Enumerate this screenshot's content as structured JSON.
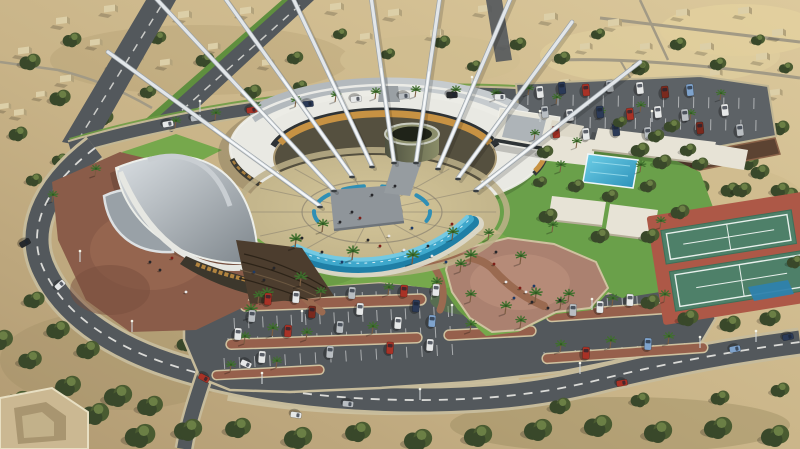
{
  "scene": {
    "title": "aerial-architectural-rendering",
    "description": "Aerial 3D render of a circular cultural center with white sail masts, crescent cascade pool, central plaza, lawns, palm-lined parking lots, pavilions with swimming pool, tennis courts and a ring road in a desert town",
    "features": {
      "masts": 9,
      "tennis_courts": 2,
      "swimming_pools": 1,
      "parking_lots": 2,
      "central_plaza": 1,
      "cascade_pool": 1
    }
  },
  "palette": {
    "sand_light": "#dcc99c",
    "sand_dark": "#b7a077",
    "sand_patch": "#a8946a",
    "sand_bright": "#e3d2a0",
    "scrub": "#4a5b31",
    "scrub_dark": "#39482a",
    "scrub_lite": "#6b7f45",
    "asphalt": "#53585c",
    "asphalt_lite": "#5d6266",
    "road_line": "#e9e9e4",
    "curb": "#c6bb9b",
    "grass": "#76a84c",
    "grass_dark": "#5f8f3e",
    "grass_east": "#6aa04a",
    "gravel": "#8a5c49",
    "gravel_lite": "#9c6b54",
    "pink_gravel": "#ab8170",
    "path_brown": "#9a6a50",
    "plaza_tile": "#cbbd92",
    "plaza_tile_dark": "#b6a981",
    "plaza_joint": "#8a8270",
    "water": "#3fa8cc",
    "water_deep": "#1f7fa6",
    "water_lite": "#74c9e2",
    "roof_white": "#e9e9e3",
    "roof_gray": "#b3b9bd",
    "glass_dark": "#2e3336",
    "gold": "#c79243",
    "drum_lite": "#8a8d68",
    "drum_dark": "#4e5140",
    "pavilion": "#e7e3d6",
    "court_red": "#ad5847",
    "court_green": "#4e8069",
    "mast": "#e2e6e9"
  },
  "car_colors": {
    "white": "#e6e8e8",
    "silver": "#b9bec2",
    "red": "#a83226",
    "darkred": "#7a2a1e",
    "navy": "#2b3a57",
    "black": "#26282b",
    "blue": "#7fa3cc"
  },
  "desert_buildings": [
    [
      18,
      48,
      1
    ],
    [
      56,
      18,
      1
    ],
    [
      104,
      6,
      1
    ],
    [
      178,
      12,
      1
    ],
    [
      240,
      8,
      1
    ],
    [
      330,
      4,
      1
    ],
    [
      388,
      10,
      1
    ],
    [
      430,
      30,
      1
    ],
    [
      478,
      6,
      1
    ],
    [
      544,
      14,
      1
    ],
    [
      608,
      20,
      1
    ],
    [
      676,
      10,
      1
    ],
    [
      738,
      8,
      1
    ],
    [
      772,
      30,
      1
    ],
    [
      700,
      44,
      1
    ],
    [
      756,
      54,
      1
    ],
    [
      60,
      76,
      1
    ],
    [
      14,
      110,
      0.9
    ],
    [
      130,
      54,
      1
    ],
    [
      208,
      44,
      0.9
    ],
    [
      262,
      60,
      0.9
    ],
    [
      360,
      34,
      0.9
    ],
    [
      580,
      44,
      0.9
    ],
    [
      640,
      44,
      0.9
    ],
    [
      710,
      70,
      0.9
    ],
    [
      770,
      90,
      0.9
    ],
    [
      0,
      104,
      0.8
    ],
    [
      36,
      92,
      0.8
    ],
    [
      90,
      40,
      0.9
    ],
    [
      160,
      60,
      0.9
    ],
    [
      500,
      40,
      0.9
    ],
    [
      560,
      80,
      0.8
    ]
  ],
  "trees_far": [
    [
      30,
      62,
      9
    ],
    [
      72,
      40,
      8
    ],
    [
      118,
      66,
      9
    ],
    [
      158,
      38,
      7
    ],
    [
      205,
      60,
      8
    ],
    [
      248,
      40,
      7
    ],
    [
      295,
      58,
      7
    ],
    [
      340,
      34,
      6
    ],
    [
      388,
      54,
      6
    ],
    [
      442,
      42,
      7
    ],
    [
      474,
      66,
      6
    ],
    [
      518,
      44,
      7
    ],
    [
      562,
      58,
      7
    ],
    [
      598,
      34,
      6
    ],
    [
      252,
      92,
      8
    ],
    [
      300,
      86,
      6
    ],
    [
      60,
      98,
      9
    ],
    [
      18,
      134,
      8
    ],
    [
      104,
      118,
      8
    ],
    [
      148,
      92,
      7
    ],
    [
      196,
      88,
      6
    ],
    [
      640,
      68,
      8
    ],
    [
      678,
      44,
      7
    ],
    [
      718,
      64,
      7
    ],
    [
      758,
      40,
      6
    ],
    [
      786,
      68,
      6
    ],
    [
      700,
      94,
      7
    ],
    [
      744,
      108,
      7
    ],
    [
      780,
      128,
      8
    ],
    [
      638,
      118,
      7
    ],
    [
      608,
      92,
      6
    ],
    [
      662,
      132,
      7
    ],
    [
      700,
      160,
      8
    ],
    [
      748,
      162,
      9
    ],
    [
      788,
      196,
      9
    ],
    [
      760,
      172,
      8
    ],
    [
      730,
      190,
      8
    ],
    [
      795,
      232,
      8
    ],
    [
      60,
      160,
      7
    ],
    [
      34,
      180,
      7
    ],
    [
      120,
      214,
      8
    ],
    [
      100,
      250,
      7
    ],
    [
      148,
      320,
      8
    ],
    [
      186,
      344,
      8
    ],
    [
      656,
      196,
      8
    ],
    [
      700,
      188,
      8
    ],
    [
      742,
      190,
      8
    ],
    [
      780,
      190,
      8
    ]
  ],
  "trees_mid": [
    [
      545,
      152,
      7
    ],
    [
      640,
      150,
      8
    ],
    [
      656,
      136,
      7
    ],
    [
      576,
      186,
      7
    ],
    [
      648,
      186,
      7
    ],
    [
      610,
      196,
      7
    ],
    [
      548,
      216,
      8
    ],
    [
      600,
      236,
      8
    ],
    [
      650,
      236,
      8
    ],
    [
      680,
      212,
      8
    ],
    [
      620,
      122,
      6
    ],
    [
      672,
      126,
      7
    ],
    [
      700,
      164,
      7
    ],
    [
      540,
      182,
      6
    ],
    [
      662,
      162,
      8
    ],
    [
      688,
      150,
      7
    ]
  ],
  "trees_near": [
    [
      48,
      430,
      14
    ],
    [
      95,
      414,
      12
    ],
    [
      140,
      436,
      13
    ],
    [
      188,
      430,
      12
    ],
    [
      238,
      428,
      11
    ],
    [
      298,
      438,
      12
    ],
    [
      358,
      432,
      11
    ],
    [
      418,
      440,
      12
    ],
    [
      478,
      436,
      12
    ],
    [
      538,
      430,
      12
    ],
    [
      598,
      426,
      12
    ],
    [
      658,
      432,
      12
    ],
    [
      718,
      428,
      12
    ],
    [
      775,
      436,
      12
    ],
    [
      18,
      402,
      12
    ],
    [
      68,
      386,
      11
    ],
    [
      118,
      396,
      12
    ],
    [
      30,
      360,
      10
    ],
    [
      58,
      330,
      10
    ],
    [
      34,
      300,
      9
    ],
    [
      88,
      350,
      10
    ],
    [
      150,
      406,
      11
    ],
    [
      0,
      340,
      11
    ],
    [
      650,
      302,
      8
    ],
    [
      688,
      318,
      9
    ],
    [
      730,
      324,
      9
    ],
    [
      770,
      318,
      9
    ],
    [
      795,
      262,
      7
    ],
    [
      560,
      406,
      9
    ],
    [
      640,
      400,
      8
    ],
    [
      720,
      398,
      8
    ],
    [
      780,
      390,
      8
    ]
  ],
  "palms": [
    [
      175,
      128,
      0.8
    ],
    [
      215,
      120,
      0.8
    ],
    [
      255,
      113,
      0.8
    ],
    [
      295,
      107,
      0.8
    ],
    [
      335,
      102,
      0.8
    ],
    [
      375,
      99,
      0.8
    ],
    [
      415,
      97,
      0.8
    ],
    [
      455,
      97,
      0.8
    ],
    [
      495,
      100,
      0.8
    ],
    [
      295,
      248,
      1
    ],
    [
      322,
      232,
      0.9
    ],
    [
      352,
      260,
      1
    ],
    [
      300,
      286,
      1
    ],
    [
      266,
      302,
      1
    ],
    [
      412,
      264,
      1
    ],
    [
      452,
      240,
      0.9
    ],
    [
      470,
      264,
      1
    ],
    [
      488,
      240,
      0.8
    ],
    [
      520,
      264,
      0.9
    ],
    [
      535,
      302,
      1
    ],
    [
      505,
      314,
      0.9
    ],
    [
      568,
      302,
      0.9
    ],
    [
      250,
      318,
      1
    ],
    [
      272,
      336,
      0.9
    ],
    [
      436,
      290,
      0.9
    ],
    [
      460,
      272,
      0.9
    ],
    [
      52,
      202,
      0.8
    ],
    [
      95,
      176,
      0.8
    ],
    [
      258,
      303,
      0.85
    ],
    [
      320,
      299,
      0.85
    ],
    [
      388,
      295,
      0.85
    ],
    [
      470,
      302,
      0.85
    ],
    [
      560,
      309,
      0.85
    ],
    [
      612,
      306,
      0.85
    ],
    [
      664,
      302,
      0.85
    ],
    [
      244,
      344,
      0.85
    ],
    [
      306,
      340,
      0.85
    ],
    [
      372,
      334,
      0.85
    ],
    [
      470,
      332,
      0.85
    ],
    [
      520,
      328,
      0.85
    ],
    [
      560,
      352,
      0.85
    ],
    [
      610,
      348,
      0.85
    ],
    [
      668,
      344,
      0.85
    ],
    [
      230,
      372,
      0.8
    ],
    [
      276,
      368,
      0.8
    ],
    [
      528,
      95,
      0.75
    ],
    [
      556,
      104,
      0.75
    ],
    [
      600,
      118,
      0.75
    ],
    [
      640,
      112,
      0.75
    ],
    [
      690,
      120,
      0.75
    ],
    [
      720,
      100,
      0.75
    ],
    [
      534,
      140,
      0.75
    ],
    [
      576,
      148,
      0.75
    ],
    [
      560,
      172,
      0.8
    ],
    [
      640,
      172,
      0.8
    ],
    [
      552,
      232,
      0.8
    ],
    [
      660,
      228,
      0.8
    ]
  ],
  "stall_rows": [
    [
      238,
      298,
      445,
      288,
      15
    ],
    [
      234,
      318,
      448,
      306,
      15
    ],
    [
      228,
      338,
      450,
      326,
      15
    ],
    [
      224,
      358,
      452,
      344,
      15
    ],
    [
      548,
      302,
      696,
      292,
      10
    ],
    [
      544,
      352,
      700,
      342,
      10
    ],
    [
      528,
      94,
      754,
      98,
      15
    ],
    [
      530,
      116,
      756,
      120,
      15
    ]
  ],
  "parked_cars": [
    [
      268,
      299,
      4,
      "red"
    ],
    [
      296,
      297,
      4,
      "white"
    ],
    [
      352,
      293,
      4,
      "silver"
    ],
    [
      404,
      291,
      4,
      "red"
    ],
    [
      436,
      290,
      4,
      "white"
    ],
    [
      252,
      316,
      4,
      "silver"
    ],
    [
      312,
      312,
      4,
      "darkred"
    ],
    [
      360,
      309,
      4,
      "white"
    ],
    [
      416,
      306,
      4,
      "navy"
    ],
    [
      238,
      334,
      4,
      "white"
    ],
    [
      288,
      331,
      4,
      "red"
    ],
    [
      340,
      327,
      4,
      "silver"
    ],
    [
      398,
      323,
      4,
      "white"
    ],
    [
      432,
      321,
      4,
      "blue"
    ],
    [
      262,
      357,
      4,
      "white"
    ],
    [
      330,
      352,
      4,
      "silver"
    ],
    [
      390,
      348,
      4,
      "red"
    ],
    [
      430,
      345,
      4,
      "white"
    ],
    [
      573,
      310,
      2,
      "silver"
    ],
    [
      600,
      307,
      2,
      "white"
    ],
    [
      586,
      353,
      2,
      "red"
    ],
    [
      648,
      344,
      2,
      "blue"
    ],
    [
      630,
      300,
      2,
      "white"
    ],
    [
      540,
      92,
      -6,
      "white"
    ],
    [
      562,
      88,
      -6,
      "navy"
    ],
    [
      586,
      90,
      -6,
      "red"
    ],
    [
      610,
      86,
      -6,
      "silver"
    ],
    [
      640,
      88,
      -6,
      "white"
    ],
    [
      665,
      92,
      -6,
      "darkred"
    ],
    [
      690,
      90,
      -6,
      "blue"
    ],
    [
      545,
      112,
      -6,
      "silver"
    ],
    [
      570,
      115,
      -6,
      "white"
    ],
    [
      600,
      112,
      -6,
      "navy"
    ],
    [
      630,
      114,
      -6,
      "red"
    ],
    [
      658,
      112,
      -6,
      "white"
    ],
    [
      685,
      115,
      -6,
      "silver"
    ],
    [
      556,
      132,
      -6,
      "red"
    ],
    [
      586,
      134,
      -6,
      "white"
    ],
    [
      616,
      130,
      -6,
      "navy"
    ],
    [
      648,
      133,
      -6,
      "silver"
    ],
    [
      700,
      128,
      -6,
      "darkred"
    ],
    [
      725,
      110,
      -6,
      "white"
    ],
    [
      740,
      130,
      -6,
      "silver"
    ]
  ],
  "road_cars": [
    [
      168,
      124,
      80,
      "white"
    ],
    [
      196,
      118,
      80,
      "silver"
    ],
    [
      252,
      110,
      82,
      "red"
    ],
    [
      308,
      104,
      84,
      "navy"
    ],
    [
      356,
      99,
      85,
      "white"
    ],
    [
      404,
      96,
      86,
      "silver"
    ],
    [
      452,
      95,
      88,
      "black"
    ],
    [
      500,
      97,
      90,
      "white"
    ],
    [
      25,
      243,
      60,
      "black"
    ],
    [
      60,
      285,
      48,
      "white"
    ],
    [
      204,
      378,
      118,
      "red"
    ],
    [
      246,
      364,
      115,
      "white"
    ],
    [
      296,
      415,
      98,
      "white"
    ],
    [
      348,
      404,
      95,
      "silver"
    ],
    [
      622,
      383,
      81,
      "red"
    ],
    [
      735,
      349,
      79,
      "blue"
    ],
    [
      788,
      337,
      78,
      "navy"
    ]
  ],
  "people": [
    [
      352,
      212
    ],
    [
      360,
      218
    ],
    [
      389,
      236
    ],
    [
      412,
      228
    ],
    [
      428,
      246
    ],
    [
      302,
      238
    ],
    [
      322,
      252
    ],
    [
      452,
      224
    ],
    [
      432,
      256
    ],
    [
      446,
      262
    ],
    [
      372,
      195
    ],
    [
      395,
      186
    ],
    [
      340,
      222
    ],
    [
      494,
      264
    ],
    [
      506,
      282
    ],
    [
      514,
      298
    ],
    [
      532,
      302
    ],
    [
      548,
      308
    ],
    [
      496,
      252
    ],
    [
      520,
      288
    ],
    [
      526,
      292
    ],
    [
      534,
      286
    ],
    [
      560,
      300
    ],
    [
      150,
      262
    ],
    [
      160,
      270
    ],
    [
      172,
      258
    ],
    [
      186,
      292
    ],
    [
      254,
      272
    ],
    [
      264,
      280
    ],
    [
      274,
      268
    ],
    [
      368,
      240
    ],
    [
      380,
      246
    ],
    [
      404,
      250
    ],
    [
      342,
      262
    ]
  ],
  "people_colors": [
    "#26262a",
    "#7e1f18",
    "#e8e8e8",
    "#1d3a66",
    "#26262a",
    "#26262a"
  ],
  "light_poles": [
    [
      118,
      180
    ],
    [
      80,
      262
    ],
    [
      132,
      332
    ],
    [
      262,
      384
    ],
    [
      420,
      400
    ],
    [
      580,
      374
    ],
    [
      700,
      348
    ],
    [
      302,
      322
    ],
    [
      452,
      316
    ],
    [
      592,
      310
    ],
    [
      540,
      122
    ],
    [
      652,
      122
    ],
    [
      200,
      112
    ],
    [
      332,
      92
    ],
    [
      472,
      88
    ],
    [
      756,
      342
    ]
  ],
  "masts": [
    [
      320,
      206,
      108,
      52
    ],
    [
      334,
      190,
      150,
      -8
    ],
    [
      352,
      176,
      212,
      -20
    ],
    [
      372,
      166,
      282,
      -25
    ],
    [
      394,
      162,
      368,
      -25
    ],
    [
      416,
      162,
      442,
      -18
    ],
    [
      438,
      168,
      512,
      -5
    ],
    [
      458,
      178,
      572,
      22
    ],
    [
      476,
      190,
      640,
      62
    ]
  ],
  "plaza": {
    "cx": 372,
    "cy": 212,
    "rx": 128,
    "ry": 57,
    "radials": 14
  }
}
